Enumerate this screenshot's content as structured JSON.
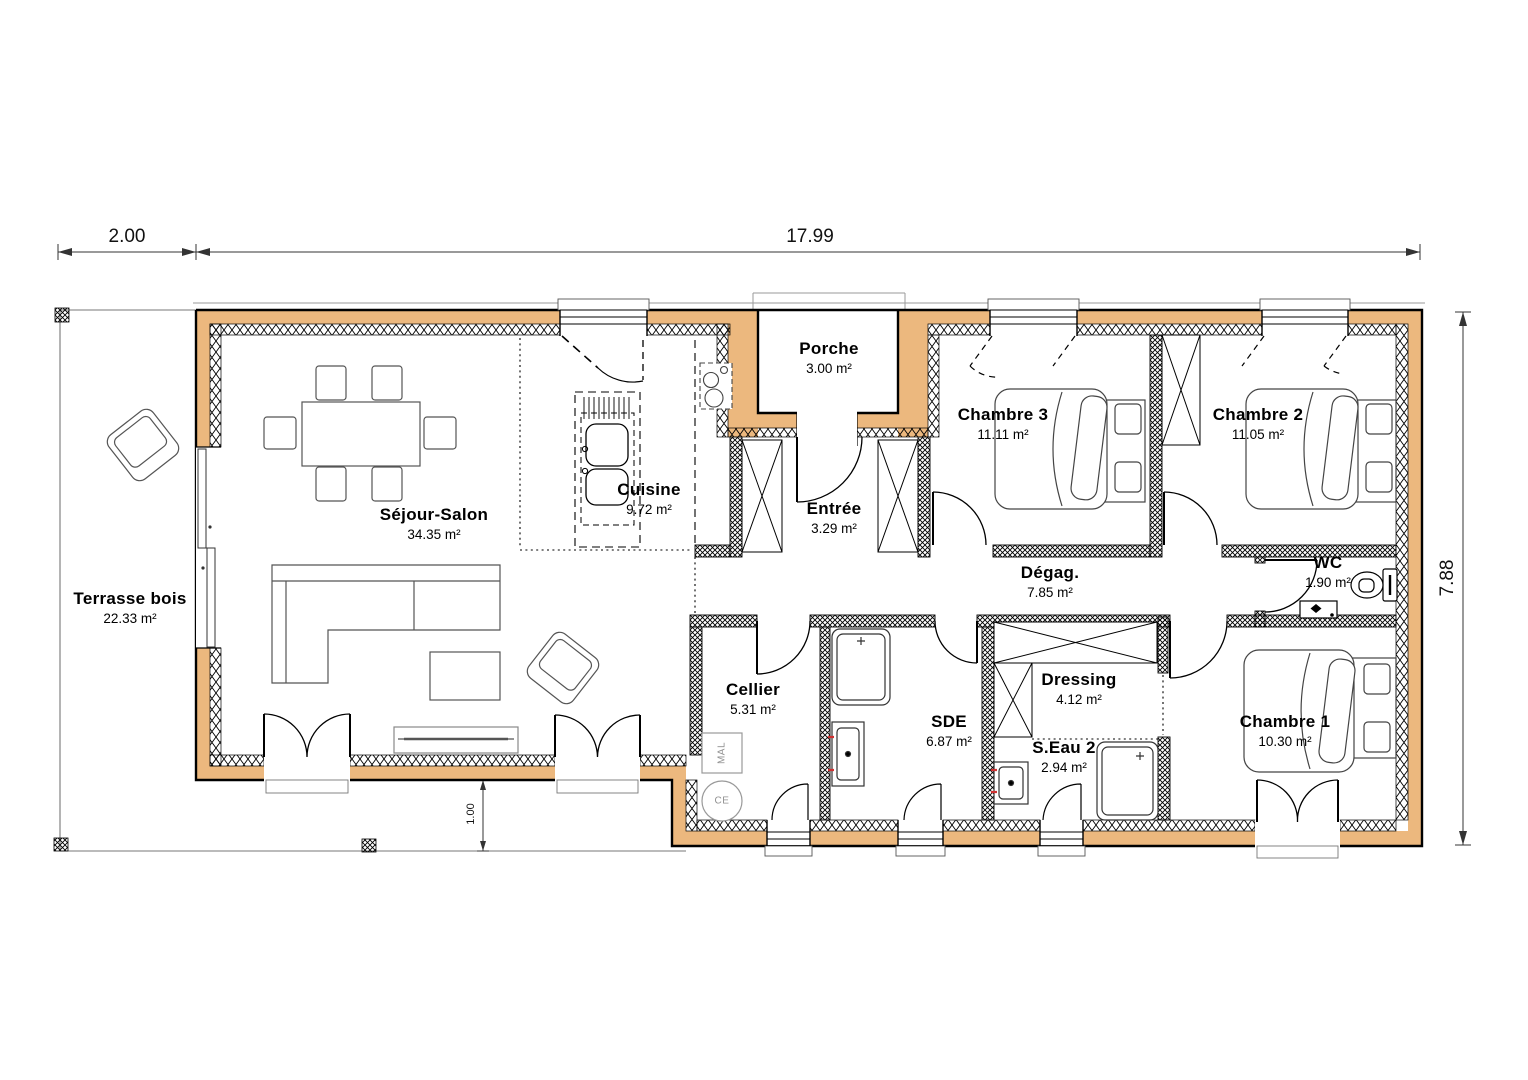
{
  "plan": {
    "rooms": {
      "terrasse": {
        "name": "Terrasse bois",
        "area": "22.33 m²"
      },
      "sejour": {
        "name": "Séjour-Salon",
        "area": "34.35 m²"
      },
      "cuisine": {
        "name": "Cuisine",
        "area": "9.72 m²"
      },
      "porche": {
        "name": "Porche",
        "area": "3.00 m²"
      },
      "entree": {
        "name": "Entrée",
        "area": "3.29 m²"
      },
      "chambre3": {
        "name": "Chambre 3",
        "area": "11.11 m²"
      },
      "chambre2": {
        "name": "Chambre 2",
        "area": "11.05 m²"
      },
      "degag": {
        "name": "Dégag.",
        "area": "7.85 m²"
      },
      "wc": {
        "name": "WC",
        "area": "1.90 m²"
      },
      "cellier": {
        "name": "Cellier",
        "area": "5.31 m²"
      },
      "sde": {
        "name": "SDE",
        "area": "6.87 m²"
      },
      "dressing": {
        "name": "Dressing",
        "area": "4.12 m²"
      },
      "seau2": {
        "name": "S.Eau 2",
        "area": "2.94 m²"
      },
      "chambre1": {
        "name": "Chambre 1",
        "area": "10.30 m²"
      }
    },
    "dimensions": {
      "left_offset": "2.00",
      "total_width": "17.99",
      "total_height": "7.88",
      "terrace_depth": "1.00"
    },
    "appliances": {
      "washing_machine": "MAL",
      "water_heater": "CE"
    },
    "colors": {
      "wall": "#ECB87E",
      "line": "#000000"
    }
  }
}
